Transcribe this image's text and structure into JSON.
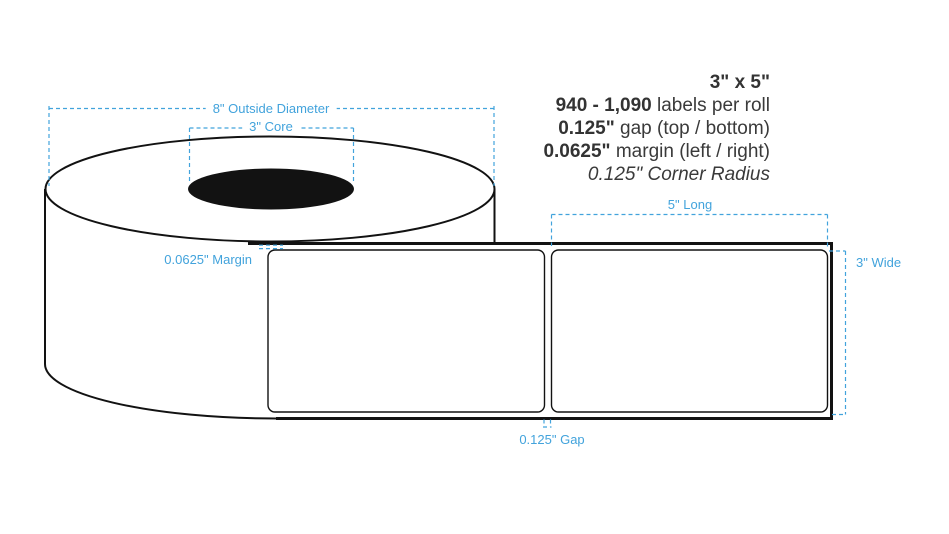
{
  "specs": {
    "size": "3\" x 5\"",
    "quantity_value": "940 - 1,090",
    "quantity_suffix": " labels per roll",
    "gap_value": "0.125\"",
    "gap_suffix": " gap (top / bottom)",
    "margin_value": "0.0625\"",
    "margin_suffix": " margin (left / right)",
    "corner_radius": "0.125\" Corner Radius"
  },
  "annotations": {
    "outside_diameter": "8\" Outside Diameter",
    "core": "3\" Core",
    "margin": "0.0625\" Margin",
    "length": "5\" Long",
    "width": "3\" Wide",
    "gap": "0.125\" Gap"
  },
  "colors": {
    "annotation_blue": "#42A3DC",
    "outline_black": "#121212",
    "text_dark": "#3a3a3a"
  }
}
